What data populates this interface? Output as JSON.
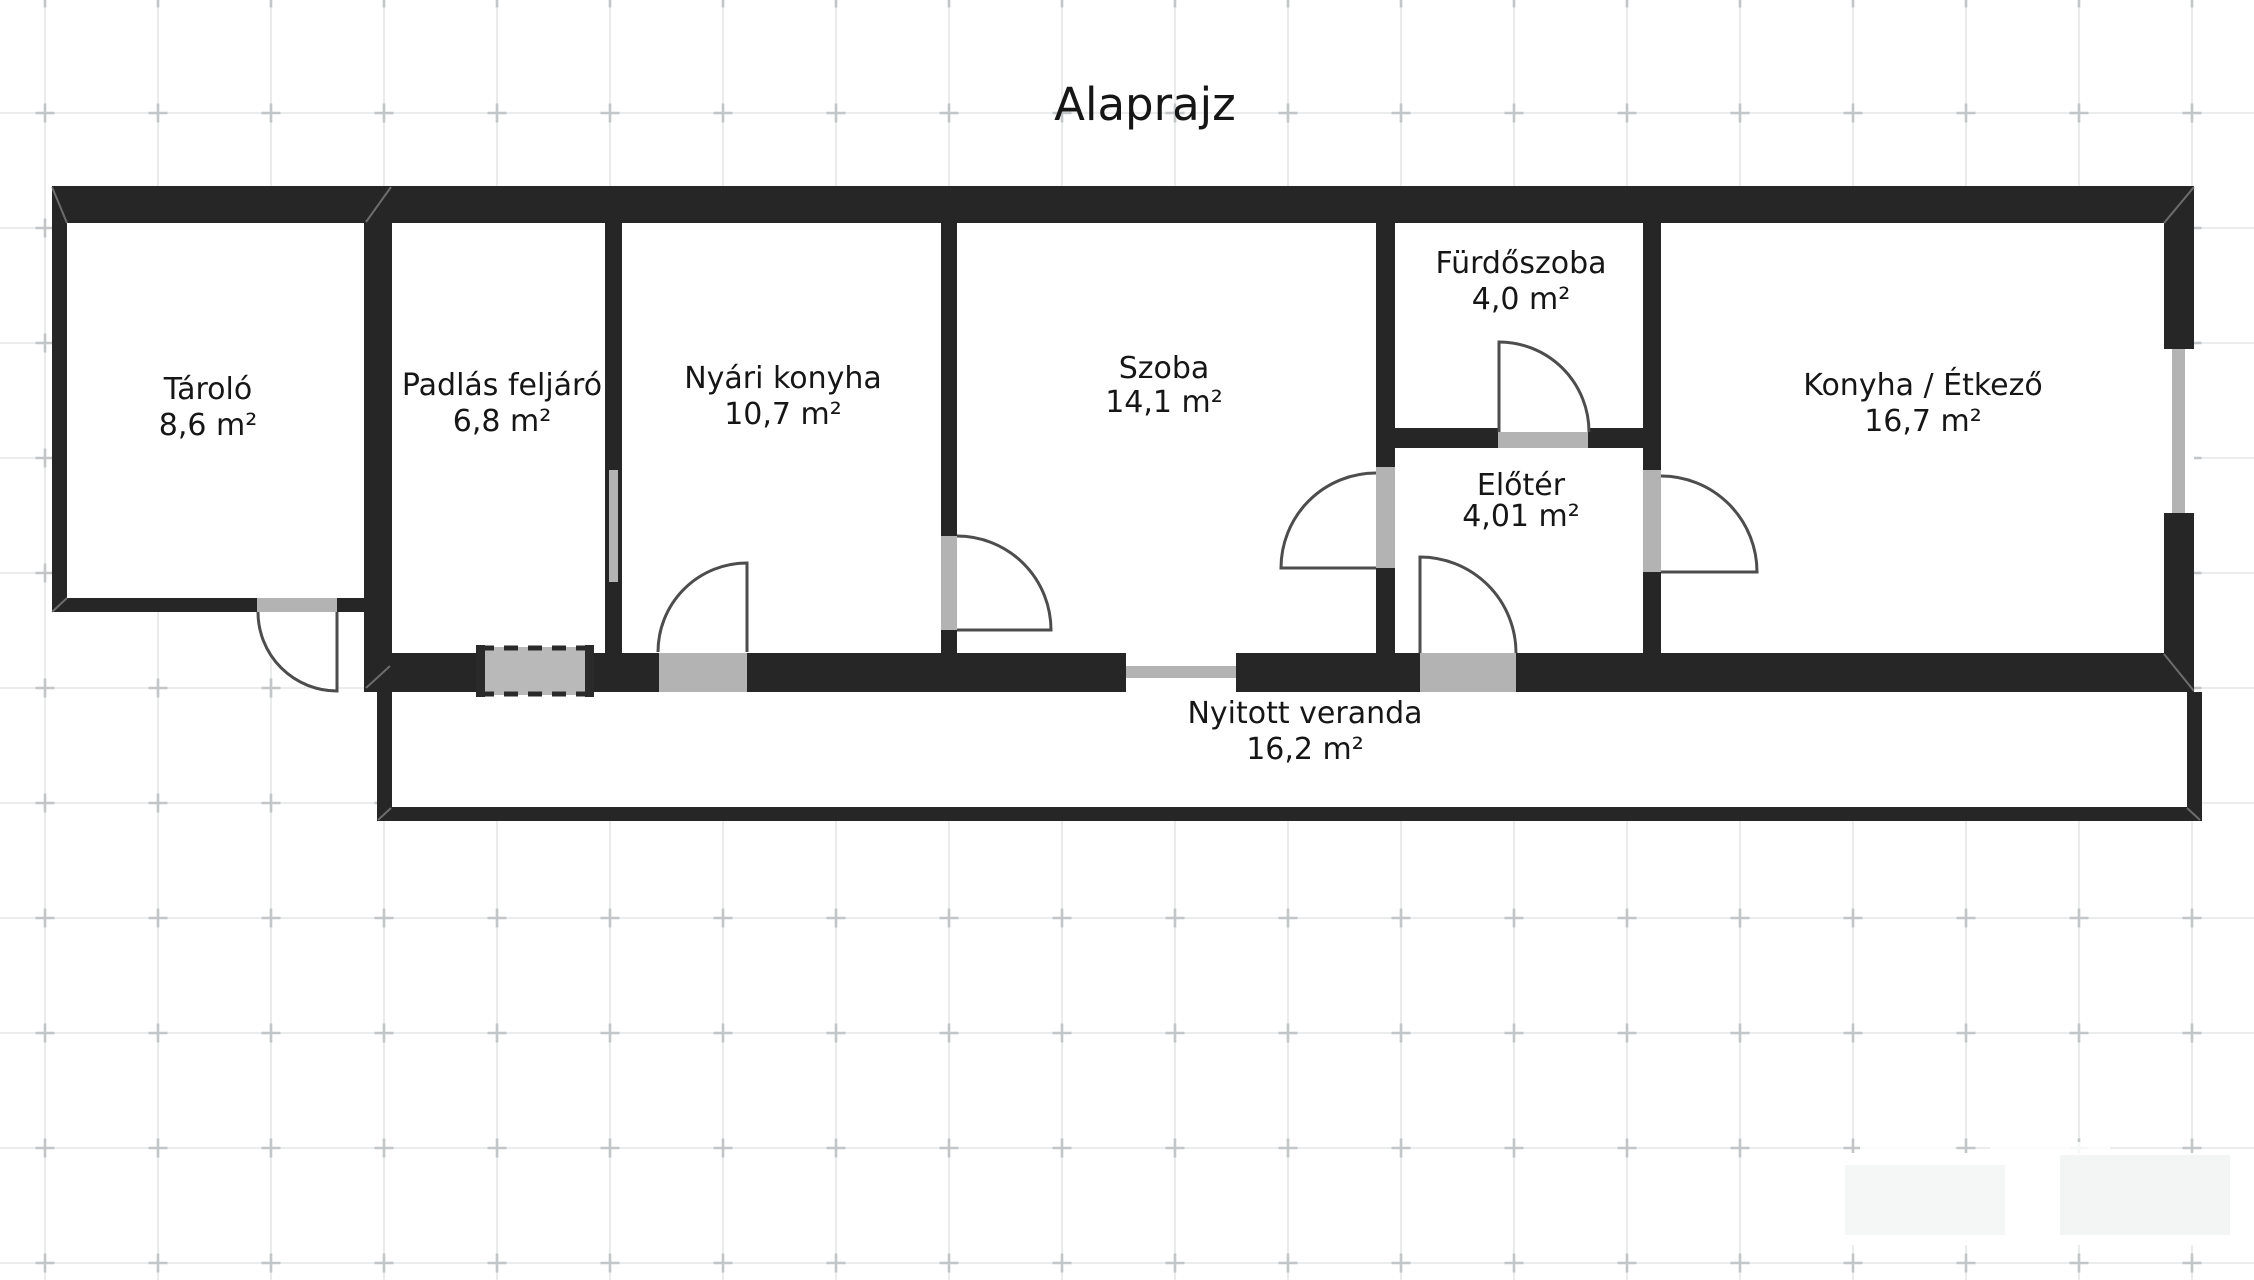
{
  "title": "Alaprajz",
  "rooms": [
    {
      "id": "tarolo",
      "name": "Tároló",
      "area": "8,6 m²"
    },
    {
      "id": "padlas",
      "name": "Padlás feljáró",
      "area": "6,8 m²"
    },
    {
      "id": "nyari",
      "name": "Nyári konyha",
      "area": "10,7 m²"
    },
    {
      "id": "szoba",
      "name": "Szoba",
      "area": "14,1 m²"
    },
    {
      "id": "furdo",
      "name": "Fürdőszoba",
      "area": "4,0 m²"
    },
    {
      "id": "eloter",
      "name": "Előtér",
      "area": "4,01 m²"
    },
    {
      "id": "konyha",
      "name": "Konyha / Étkező",
      "area": "16,7 m²"
    },
    {
      "id": "veranda",
      "name": "Nyitott veranda",
      "area": "16,2 m²"
    }
  ],
  "colors": {
    "wall": "#262626",
    "opening_threshold": "#b3b3b3",
    "door_arc_stroke": "#4d4d4d",
    "grid_line": "#dfe2e3",
    "grid_tick": "#c2c6c8",
    "text": "#161616"
  }
}
